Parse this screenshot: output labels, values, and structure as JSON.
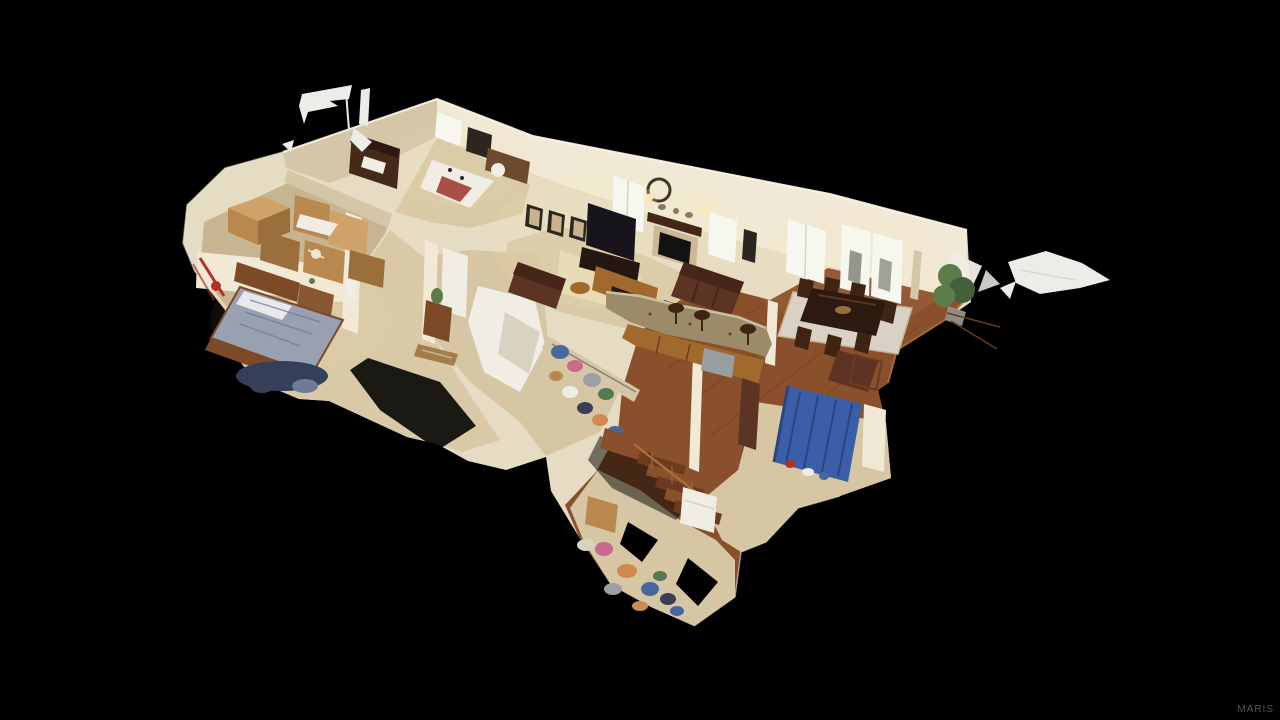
{
  "meta": {
    "canvas_width": 1280,
    "canvas_height": 720
  },
  "watermark": {
    "text": "MARIS"
  },
  "scene": {
    "kind": "3D dollhouse cutaway scan of a single-story home interior, viewed from above on a black background",
    "rooms": [
      {
        "id": "storage-room",
        "label": "storage room stacked with cardboard boxes"
      },
      {
        "id": "home-office",
        "label": "office nook with dark wood desk hutch and bright window"
      },
      {
        "id": "guest-bedroom",
        "label": "corner guest bedroom with bed"
      },
      {
        "id": "master-bedroom",
        "label": "master bedroom with wood bed, gray comforter and dresser"
      },
      {
        "id": "living-room",
        "label": "living room with TV, fireplace, framed art and leather recliners"
      },
      {
        "id": "kitchen",
        "label": "kitchen with curved granite bar, oak cabinets and stools"
      },
      {
        "id": "dining-room",
        "label": "dining room with dark wood table, chairs, rug and french doors"
      },
      {
        "id": "hallway",
        "label": "tiled hallway with folded blue cot"
      },
      {
        "id": "closet",
        "label": "closet area with hanging clothes"
      },
      {
        "id": "stairs",
        "label": "hardwood staircase descending to lower landing"
      },
      {
        "id": "lower-level",
        "label": "lower landing with scattered clothes and boxes"
      }
    ],
    "artifacts": [
      "white scan fragments floating above the roofline",
      "jagged white scan fragment floating right of the house"
    ]
  },
  "palette": {
    "bg": "#000000",
    "wallBase": "#e6dcc3",
    "wallLit": "#f1e9d5",
    "wallShade": "#d4c6a7",
    "wallDark": "#bcab89",
    "white": "#efede4",
    "window": "#f6f7ef",
    "windowFrame": "#d8d3c0",
    "carpet": "#d9c9a6",
    "carpetLit": "#e8dab9",
    "tile": "#d7c6a3",
    "tileDark": "#c7b491",
    "wood": "#8a4f2b",
    "woodDark": "#6b3a1f",
    "woodLit": "#a96d3c",
    "tv": "#17151a",
    "frameDark": "#2c2620",
    "frameMat": "#c9b28c",
    "leather": "#5c3423",
    "leatherDark": "#452619",
    "oak": "#a06a2c",
    "granite": "#9b8b68",
    "graniteLit": "#c9bfa4",
    "steel": "#9a9da0",
    "tableDark": "#2c1a10",
    "chair": "#3f2414",
    "rug": "#d9d2c4",
    "bedWood": "#7c4a26",
    "bedding": "#98a0b2",
    "beddingDark": "#6f7a96",
    "pillow": "#e9e9ec",
    "navy": "#34405a",
    "box": "#b9884e",
    "boxLit": "#cfa269",
    "boxDark": "#9a6f3c",
    "red": "#b23028",
    "guestBlanket": "#a85048",
    "stone": "#cbb896",
    "fire": "#141210",
    "cot": "#3a5fa8",
    "cotDark": "#2a4480",
    "plant": "#5c7c4a",
    "plantDark": "#44603a",
    "potGray": "#8d8d80",
    "denim": "#3a3f58",
    "clothesPink": "#c86a8a",
    "clothesOrange": "#d08a50",
    "clothesBlue": "#4a66a0",
    "clothesGray": "#9ba0a8",
    "clothesGreen": "#547850",
    "glow": "#ffe9b0",
    "artifact": "#ebeee8",
    "watermark": "#575757"
  }
}
